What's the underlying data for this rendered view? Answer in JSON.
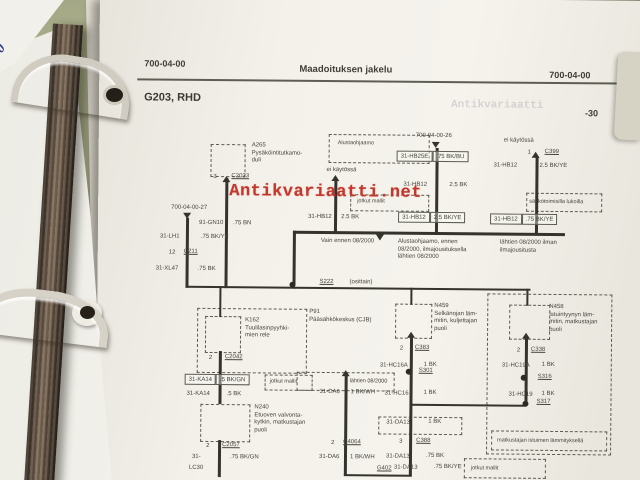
{
  "colors": {
    "ink": "#46453d",
    "wire": "#34332c",
    "page": "#f3f1ea",
    "watermark_red": "#c5372c",
    "desk_green": "#8e9372",
    "binder_brown": "#6e5c4b"
  },
  "binder": {
    "spine_digit": "0"
  },
  "watermark": {
    "text": "Antikvariaatti.net",
    "faint_text": "Antikvariaatti"
  },
  "header": {
    "left": "700-04-00",
    "center": "Maadoituksen jakelu",
    "right": "700-04-00",
    "title": "G203, RHD",
    "page_number": "-30"
  },
  "diagram": {
    "dashed_boxes": [
      {
        "x": 112,
        "y": 147,
        "w": 33,
        "h": 31,
        "n": "component-box-a265"
      },
      {
        "x": 230,
        "y": 136,
        "w": 99,
        "h": 27,
        "label": "Alustaohjaamo",
        "lx": 8,
        "ly": 5,
        "n": "region-box-alustaohjaamo"
      },
      {
        "x": 252,
        "y": 196,
        "w": 77,
        "h": 15,
        "label": "jotkut mallit",
        "lx": 6,
        "ly": 3,
        "n": "variant-box-jotkut-mallit"
      },
      {
        "x": 428,
        "y": 193,
        "w": 74,
        "h": 17,
        "label": "sähkötoimisilla lukoilla",
        "lx": 2,
        "ly": 5,
        "n": "variant-box-sahkolukot"
      },
      {
        "x": 100,
        "y": 311,
        "w": 108,
        "h": 63,
        "n": "component-box-p91"
      },
      {
        "x": 108,
        "y": 319,
        "w": 34,
        "h": 35,
        "n": "component-box-k162"
      },
      {
        "x": 168,
        "y": 377,
        "w": 46,
        "h": 14,
        "label": "jotkut mallit",
        "lx": 4,
        "ly": 3,
        "n": "variant-box-jotkut-mallit"
      },
      {
        "x": 104,
        "y": 407,
        "w": 48,
        "h": 36,
        "n": "component-box-n240"
      },
      {
        "x": 200,
        "y": 374,
        "w": 96,
        "h": 17,
        "label": "lähtien 08/2000",
        "lx": 52,
        "ly": 5,
        "n": "variant-box-lahtien"
      },
      {
        "x": 282,
        "y": 418,
        "w": 82,
        "h": 16,
        "n": "variant-box-31da13"
      },
      {
        "x": 390,
        "y": 294,
        "w": 123,
        "h": 159,
        "n": "variant-region-seat-heating"
      },
      {
        "x": 298,
        "y": 305,
        "w": 35,
        "h": 33,
        "n": "component-box-n459"
      },
      {
        "x": 412,
        "y": 305,
        "w": 39,
        "h": 33,
        "n": "component-box-n458"
      },
      {
        "x": 395,
        "y": 431,
        "w": 114,
        "h": 18,
        "label": "matkustajan istuimen lämmityksellä",
        "lx": 5,
        "ly": 6,
        "n": "variant-box-istuinlammitys"
      },
      {
        "x": 368,
        "y": 459,
        "w": 80,
        "h": 18,
        "label": "jotkut mallit",
        "lx": 6,
        "ly": 6,
        "n": "variant-box-jotkut-mallit"
      }
    ],
    "wires": [
      {
        "x": 127,
        "y": 181,
        "w": 3,
        "h": 110
      },
      {
        "x": 236,
        "y": 182,
        "w": 3,
        "h": 53
      },
      {
        "x": 337,
        "y": 149,
        "w": 3,
        "h": 86
      },
      {
        "x": 437,
        "y": 157,
        "w": 3,
        "h": 78
      },
      {
        "x": 195,
        "y": 233,
        "w": 272,
        "h": 3
      },
      {
        "x": 195,
        "y": 233,
        "w": 3,
        "h": 54
      },
      {
        "x": 88,
        "y": 221,
        "w": 3,
        "h": 70
      },
      {
        "x": 88,
        "y": 289,
        "w": 110,
        "h": 2
      },
      {
        "x": 197,
        "y": 289,
        "w": 236,
        "h": 2
      },
      {
        "x": 122,
        "y": 289,
        "w": 2,
        "h": 31
      },
      {
        "x": 313,
        "y": 289,
        "w": 2,
        "h": 17
      },
      {
        "x": 429,
        "y": 289,
        "w": 2,
        "h": 17
      },
      {
        "x": 122,
        "y": 354,
        "w": 3,
        "h": 53
      },
      {
        "x": 122,
        "y": 443,
        "w": 3,
        "h": 37
      },
      {
        "x": 248,
        "y": 377,
        "w": 3,
        "h": 100
      },
      {
        "x": 313,
        "y": 338,
        "w": 3,
        "h": 139
      },
      {
        "x": 428,
        "y": 338,
        "w": 3,
        "h": 68
      },
      {
        "x": 315,
        "y": 405,
        "w": 114,
        "h": 2
      },
      {
        "x": 248,
        "y": 476,
        "w": 68,
        "h": 2
      }
    ],
    "dots": [
      {
        "x": 192,
        "y": 284,
        "n": "splice-dot-s222"
      },
      {
        "x": 309,
        "y": 370,
        "n": "splice-dot-s301"
      },
      {
        "x": 424,
        "y": 375,
        "n": "splice-dot-s316"
      },
      {
        "x": 426,
        "y": 401,
        "n": "splice-dot-s317"
      }
    ],
    "arrows": [
      {
        "x": 124,
        "y": 179,
        "dir": "up"
      },
      {
        "x": 233,
        "y": 177,
        "dir": "up"
      },
      {
        "x": 333,
        "y": 143,
        "dir": "down"
      },
      {
        "x": 433,
        "y": 152,
        "dir": "up"
      },
      {
        "x": 85,
        "y": 216,
        "dir": "down"
      },
      {
        "x": 278,
        "y": 236,
        "dir": "down"
      },
      {
        "x": 245,
        "y": 372,
        "dir": "up"
      },
      {
        "x": 310,
        "y": 333,
        "dir": "up"
      },
      {
        "x": 425,
        "y": 333,
        "dir": "up"
      }
    ],
    "label_boxes": [
      {
        "x": 298,
        "y": 152,
        "a": "31-HB25E",
        "b": ".75 BK/BU"
      },
      {
        "x": 300,
        "y": 213,
        "a": "31-HB12",
        "b": "2.5 BK/YE"
      },
      {
        "x": 392,
        "y": 214,
        "a": "31-HB12",
        "b": ".75 BK/YE"
      },
      {
        "x": 88,
        "y": 377,
        "a": "31-KA14",
        "b": ".5 BK/GN"
      }
    ],
    "wire_labels": [
      {
        "x": 153,
        "y": 145,
        "t": "A265\nPysäköintitutkamo-\nduli"
      },
      {
        "x": 115,
        "y": 177,
        "t": "3"
      },
      {
        "x": 133,
        "y": 176,
        "t": "C2023",
        "u": 1
      },
      {
        "x": 228,
        "y": 169,
        "t": "ei käytössä"
      },
      {
        "x": 317,
        "y": 134,
        "t": "700-04-00-26"
      },
      {
        "x": 305,
        "y": 183,
        "t": "31-HB12"
      },
      {
        "x": 351,
        "y": 183,
        "t": "2.5 BK"
      },
      {
        "x": 405,
        "y": 138,
        "t": "ei käytössä"
      },
      {
        "x": 429,
        "y": 150,
        "t": "1"
      },
      {
        "x": 446,
        "y": 149,
        "t": "C399",
        "u": 1
      },
      {
        "x": 395,
        "y": 163,
        "t": "31-HB12"
      },
      {
        "x": 441,
        "y": 163,
        "t": "2.5 BK/YE"
      },
      {
        "x": 210,
        "y": 216,
        "t": "31-HB12"
      },
      {
        "x": 243,
        "y": 216,
        "t": "2.5 BK"
      },
      {
        "x": 223,
        "y": 240,
        "t": "Vain ennen 08/2000"
      },
      {
        "x": 300,
        "y": 240,
        "t": "Alustaohjaamo, ennen\n08/2000, ilmajousituksella\nlähtien 08/2000"
      },
      {
        "x": 402,
        "y": 240,
        "t": "lähtien 08/2000 ilman\nilmajousitusta"
      },
      {
        "x": 222,
        "y": 281,
        "t": "S222",
        "u": 1
      },
      {
        "x": 252,
        "y": 281,
        "t": "(osittain)"
      },
      {
        "x": 73,
        "y": 208,
        "t": "700-04-00-27"
      },
      {
        "x": 101,
        "y": 223,
        "t": "91-GN10"
      },
      {
        "x": 135,
        "y": 223,
        "t": ".75 BN"
      },
      {
        "x": 62,
        "y": 237,
        "t": "31-LH1"
      },
      {
        "x": 103,
        "y": 237,
        "t": ".75 BK/YE"
      },
      {
        "x": 71,
        "y": 253,
        "t": "12"
      },
      {
        "x": 86,
        "y": 252,
        "t": "C211",
        "u": 1
      },
      {
        "x": 58,
        "y": 269,
        "t": "31-XL47"
      },
      {
        "x": 100,
        "y": 269,
        "t": ".75 BK"
      },
      {
        "x": 212,
        "y": 311,
        "t": "P91\nPääsähkökeskus (CJB)"
      },
      {
        "x": 148,
        "y": 320,
        "t": "K162\nTuulilasinpyyhki-\nmien rele"
      },
      {
        "x": 112,
        "y": 358,
        "t": "2"
      },
      {
        "x": 128,
        "y": 357,
        "t": "C2042",
        "u": 1
      },
      {
        "x": 90,
        "y": 394,
        "t": "31-KA14"
      },
      {
        "x": 130,
        "y": 394,
        "t": ".5 BK"
      },
      {
        "x": 158,
        "y": 407,
        "t": "N240\nEtuoven valvonta-\nkytkin, matkustajan\npuoli"
      },
      {
        "x": 110,
        "y": 446,
        "t": "2"
      },
      {
        "x": 126,
        "y": 445,
        "t": "C2057",
        "u": 1
      },
      {
        "x": 96,
        "y": 457,
        "t": "31-"
      },
      {
        "x": 93,
        "y": 468,
        "t": "LC30"
      },
      {
        "x": 134,
        "y": 457,
        "t": ".75 BK/GN"
      },
      {
        "x": 223,
        "y": 391,
        "t": "31-DA6"
      },
      {
        "x": 254,
        "y": 391,
        "t": "1 BK/WH"
      },
      {
        "x": 235,
        "y": 442,
        "t": "2"
      },
      {
        "x": 247,
        "y": 441,
        "t": "C4064",
        "u": 1
      },
      {
        "x": 223,
        "y": 456,
        "t": "31-DA6"
      },
      {
        "x": 254,
        "y": 456,
        "t": "1 BK/WH"
      },
      {
        "x": 281,
        "y": 467,
        "t": "G402",
        "u": 1
      },
      {
        "x": 337,
        "y": 304,
        "t": "N459\nSelkänojan läm-\nmitin, kuljettajan\npuoli"
      },
      {
        "x": 303,
        "y": 347,
        "t": "2"
      },
      {
        "x": 318,
        "y": 346,
        "t": "C383",
        "u": 1
      },
      {
        "x": 283,
        "y": 364,
        "t": "31-HC16A"
      },
      {
        "x": 327,
        "y": 363,
        "t": "1 BK"
      },
      {
        "x": 322,
        "y": 369,
        "t": "S301",
        "u": 1
      },
      {
        "x": 288,
        "y": 392,
        "t": "31-HC16"
      },
      {
        "x": 327,
        "y": 391,
        "t": "1 BK"
      },
      {
        "x": 290,
        "y": 421,
        "t": "31-DA13"
      },
      {
        "x": 332,
        "y": 420,
        "t": "1 BK"
      },
      {
        "x": 303,
        "y": 440,
        "t": "3"
      },
      {
        "x": 320,
        "y": 439,
        "t": "C388",
        "u": 1
      },
      {
        "x": 290,
        "y": 455,
        "t": "31-DA13"
      },
      {
        "x": 330,
        "y": 454,
        "t": ".75 BK"
      },
      {
        "x": 298,
        "y": 466,
        "t": "31-DA13"
      },
      {
        "x": 338,
        "y": 465,
        "t": ".75 BK/YE"
      },
      {
        "x": 452,
        "y": 304,
        "t": "N458\nIstuintyynyn läm-\nmitin, matkustajan\npuoli"
      },
      {
        "x": 420,
        "y": 348,
        "t": "2"
      },
      {
        "x": 434,
        "y": 347,
        "t": "C338",
        "u": 1
      },
      {
        "x": 405,
        "y": 363,
        "t": "31-HC19A"
      },
      {
        "x": 445,
        "y": 362,
        "t": "1 BK"
      },
      {
        "x": 441,
        "y": 374,
        "t": "S316",
        "u": 1
      },
      {
        "x": 412,
        "y": 392,
        "t": "31-HC19"
      },
      {
        "x": 445,
        "y": 391,
        "t": "1 BK"
      },
      {
        "x": 440,
        "y": 399,
        "t": "S317",
        "u": 1
      }
    ]
  }
}
